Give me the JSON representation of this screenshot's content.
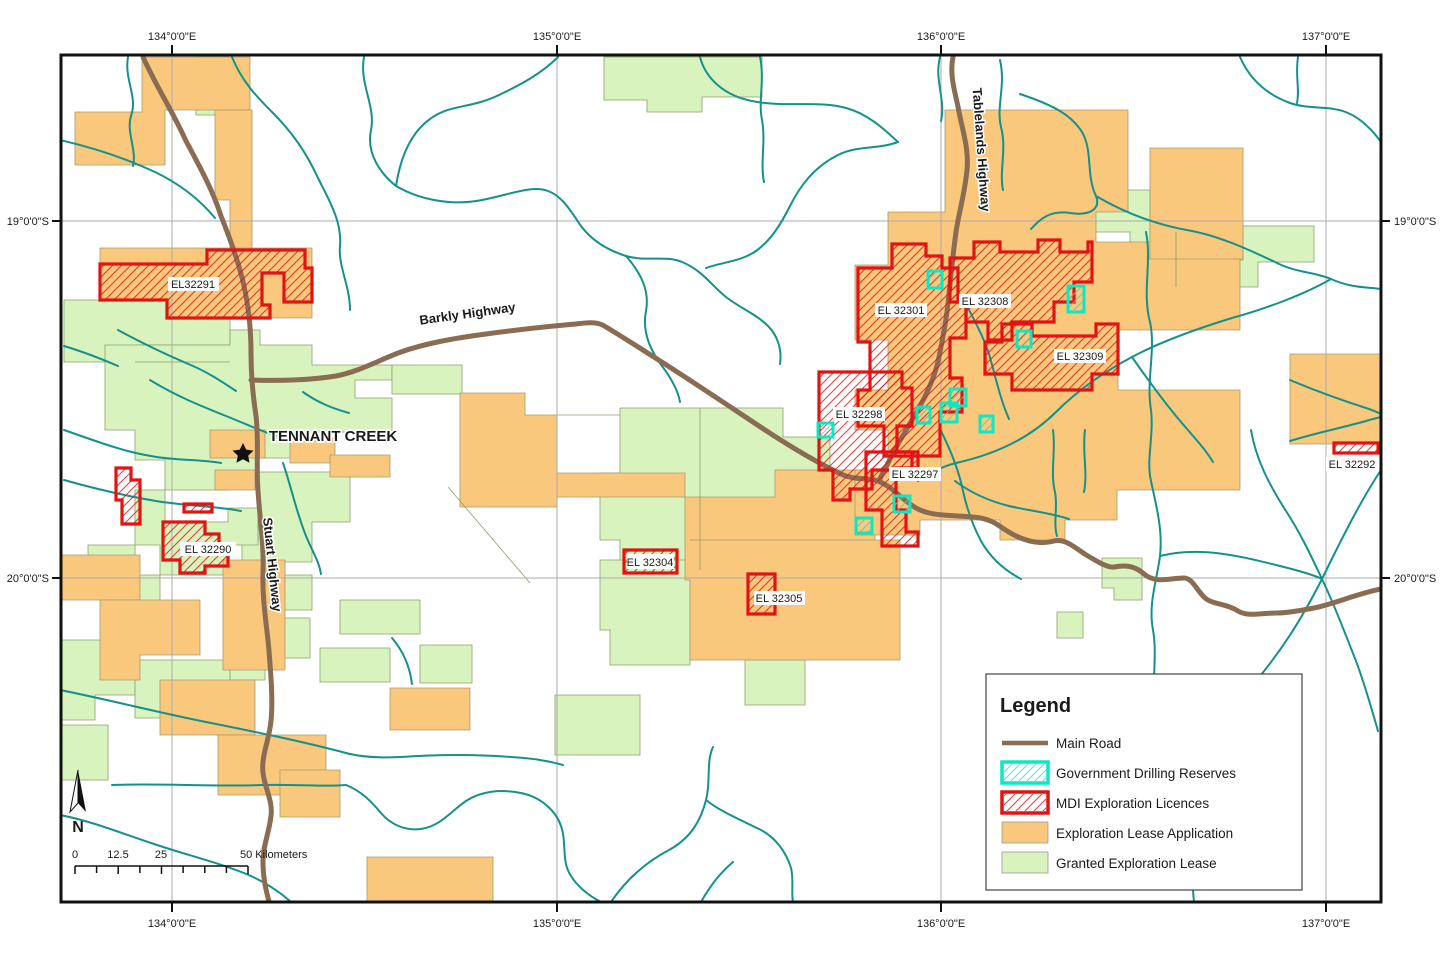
{
  "graticule": {
    "lon_labels": [
      "134°0'0\"E",
      "135°0'0\"E",
      "136°0'0\"E",
      "137°0'0\"E"
    ],
    "lat_labels": [
      "19°0'0\"S",
      "20°0'0\"S"
    ]
  },
  "place": {
    "tennant_creek": "TENNANT CREEK"
  },
  "roads": {
    "barkly": "Barkly Highway",
    "stuart": "Stuart Highway",
    "tablelands": "Tablelands Highway"
  },
  "licences": {
    "el32291": "EL32291",
    "el32290": "EL 32290",
    "el32304": "EL 32304",
    "el32305": "EL 32305",
    "el32298": "EL 32298",
    "el32301": "EL 32301",
    "el32308": "EL 32308",
    "el32309": "EL 32309",
    "el32297": "EL 32297",
    "el32292": "EL 32292"
  },
  "legend": {
    "title": "Legend",
    "items": [
      {
        "label": "Main Road",
        "swatch": "line",
        "color": "#8a6c53"
      },
      {
        "label": "Government Drilling Reserves",
        "swatch": "hatch-outline",
        "color": "#0ce9c2"
      },
      {
        "label": "MDI Exploration Licences",
        "swatch": "hatch-outline",
        "color": "#e21313"
      },
      {
        "label": "Exploration Lease Application",
        "swatch": "fill",
        "color": "#f9c87d"
      },
      {
        "label": "Granted Exploration Lease",
        "swatch": "fill",
        "color": "#d9f3be"
      }
    ]
  },
  "scalebar": {
    "tick_labels": [
      "0",
      "12.5",
      "25"
    ],
    "end_label": "50 Kilometers"
  },
  "north_arrow": {
    "label": "N"
  },
  "colors": {
    "exploration_lease_application": "#f9c87d",
    "granted_exploration_lease": "#d9f3be",
    "river": "#14918c",
    "main_road": "#8a6c53",
    "mdi_licence_outline": "#e21313",
    "drilling_reserve_outline": "#0ce9c2",
    "graticule": "#ababab",
    "frame": "#111111"
  }
}
